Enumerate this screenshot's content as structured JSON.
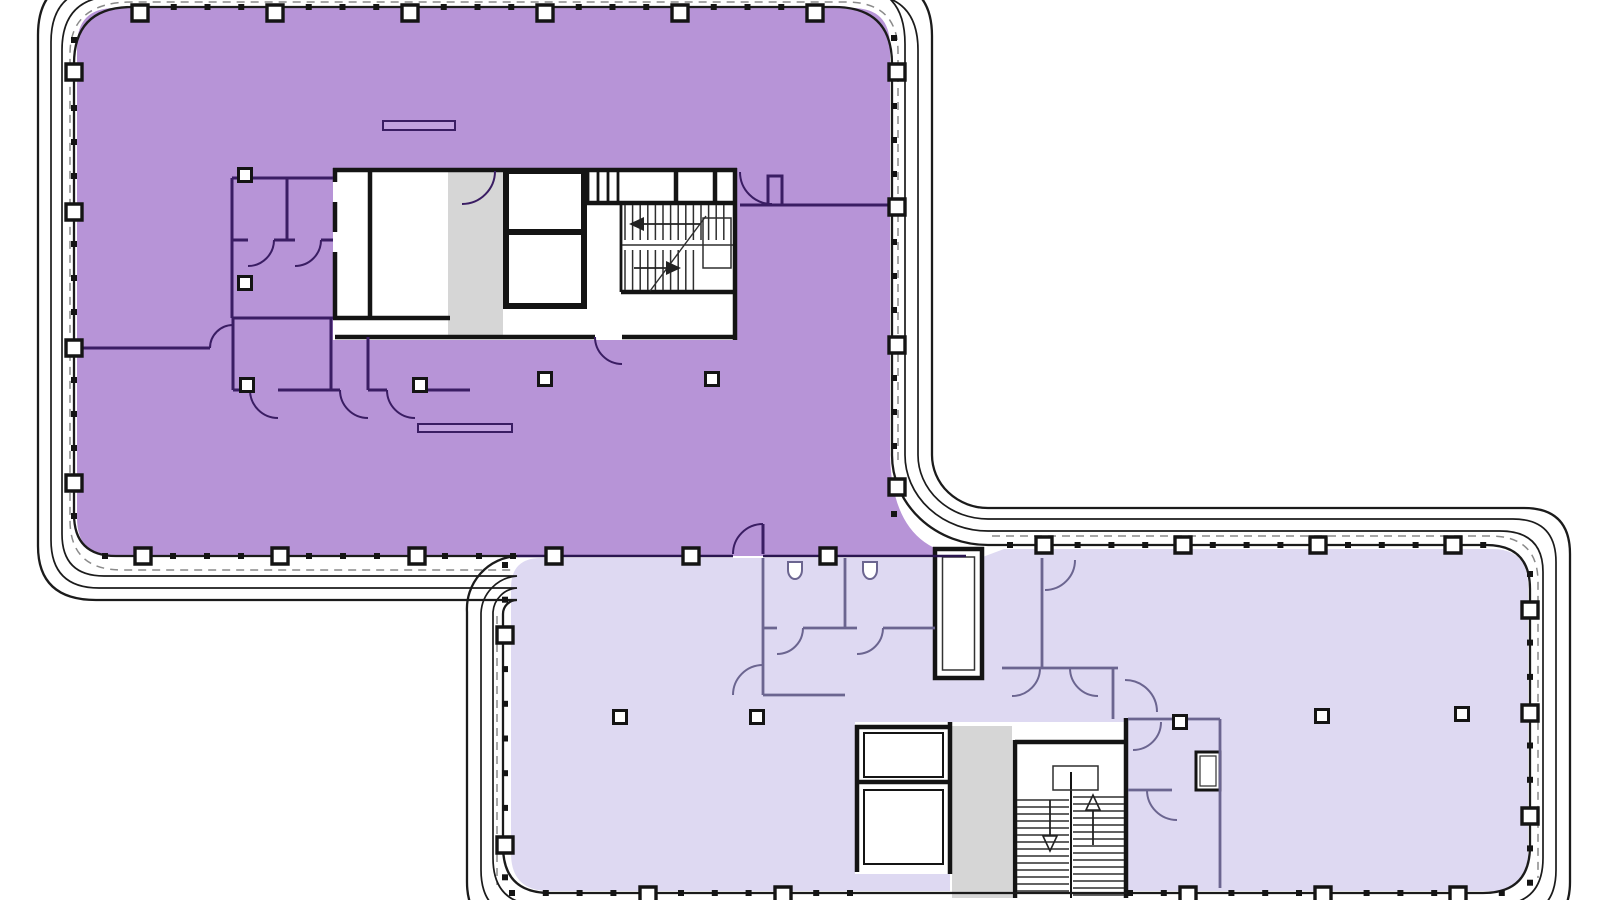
{
  "meta": {
    "type": "architectural-floor-plan",
    "description": "Office building floor plate with two highlighted suites, two service cores with stairs and elevators, curtain-wall perimeter with columns"
  },
  "colors": {
    "background": "#ffffff",
    "line": "#1b1b1b",
    "wall_black": "#141414",
    "suite_a_fill": "#b794d7",
    "suite_a_wall": "#3a1d63",
    "suite_a_demising": "#2a1650",
    "suite_b_fill": "#ded9f2",
    "suite_b_wall": "#6b6590",
    "core_fill": "#ffffff",
    "corridor_gray": "#d6d6d6",
    "dash_gray": "#8a8a8a",
    "stair_line": "#2e2e2e",
    "arrow": "#222222",
    "furniture_fill": "#c2a2df"
  },
  "suites": [
    {
      "id": "suite-upper-left",
      "fill_key": "suite_a_fill",
      "position": "upper-left block"
    },
    {
      "id": "suite-lower-right",
      "fill_key": "suite_b_fill",
      "position": "lower-right block"
    }
  ],
  "geometry": {
    "walls": [
      {
        "id": "a-top",
        "o": "h",
        "col_c": 13,
        "tick_c": 7,
        "cols": [
          140,
          275,
          410,
          545,
          680,
          815
        ],
        "t0": 140,
        "t1": 830,
        "step": 33.75,
        "size": 16
      },
      {
        "id": "a-left",
        "o": "v",
        "col_c": 74,
        "tick_c": 74,
        "cols": [
          72,
          212,
          348,
          483
        ],
        "t0": 40,
        "t1": 517,
        "step": 34,
        "size": 16
      },
      {
        "id": "a-bottom",
        "o": "h",
        "col_c": 556,
        "tick_c": 556,
        "cols": [
          143,
          280,
          417,
          554,
          691,
          828
        ],
        "t0": 105,
        "t1": 514,
        "step": 34,
        "size": 16
      },
      {
        "id": "a-right",
        "o": "v",
        "col_c": 897,
        "tick_c": 894,
        "cols": [
          72,
          207,
          345,
          487
        ],
        "t0": 38,
        "t1": 520,
        "step": 34,
        "size": 16
      },
      {
        "id": "b-top",
        "o": "h",
        "col_c": 545,
        "tick_c": 545,
        "cols": [
          1044,
          1183,
          1318,
          1453
        ],
        "t0": 1010,
        "t1": 1487,
        "step": 33.8,
        "size": 16
      },
      {
        "id": "b-left",
        "o": "v",
        "col_c": 505,
        "tick_c": 505,
        "cols": [
          635,
          845
        ],
        "t0": 565,
        "t1": 885,
        "step": 34.7,
        "size": 16
      },
      {
        "id": "b-right",
        "o": "v",
        "col_c": 1530,
        "tick_c": 1530,
        "cols": [
          610,
          713,
          816
        ],
        "t0": 574,
        "t1": 886,
        "step": 34.3,
        "size": 16
      },
      {
        "id": "b-bottom-west",
        "o": "h",
        "col_c": 895,
        "tick_c": 893,
        "cols": [
          648,
          783
        ],
        "t0": 512,
        "t1": 850,
        "step": 33.8,
        "size": 16
      },
      {
        "id": "b-bottom-east",
        "o": "h",
        "col_c": 895,
        "tick_c": 893,
        "cols": [
          1188,
          1323,
          1458
        ],
        "t0": 1130,
        "t1": 1520,
        "step": 33.8,
        "size": 16
      }
    ],
    "interior_columns": [
      [
        245,
        175
      ],
      [
        245,
        283
      ],
      [
        247,
        385
      ],
      [
        420,
        385
      ],
      [
        545,
        379
      ],
      [
        712,
        379
      ],
      [
        620,
        717
      ],
      [
        757,
        717
      ],
      [
        1180,
        722
      ],
      [
        1322,
        716
      ],
      [
        1462,
        714
      ]
    ],
    "stairs": [
      {
        "id": "stair-1-upper-flight",
        "o": "v",
        "a0": 625,
        "a1": 731,
        "step": 7.6,
        "b0": 205,
        "b1": 240
      },
      {
        "id": "stair-1-lower-flight",
        "o": "v",
        "a0": 625,
        "a1": 697,
        "step": 7.6,
        "b0": 250,
        "b1": 290
      },
      {
        "id": "stair-2-left-flight",
        "o": "h",
        "a0": 800,
        "a1": 891,
        "step": 7,
        "b0": 1017,
        "b1": 1069
      },
      {
        "id": "stair-2-right-flight",
        "o": "h",
        "a0": 797,
        "a1": 895,
        "step": 7,
        "b0": 1073,
        "b1": 1124
      }
    ]
  }
}
